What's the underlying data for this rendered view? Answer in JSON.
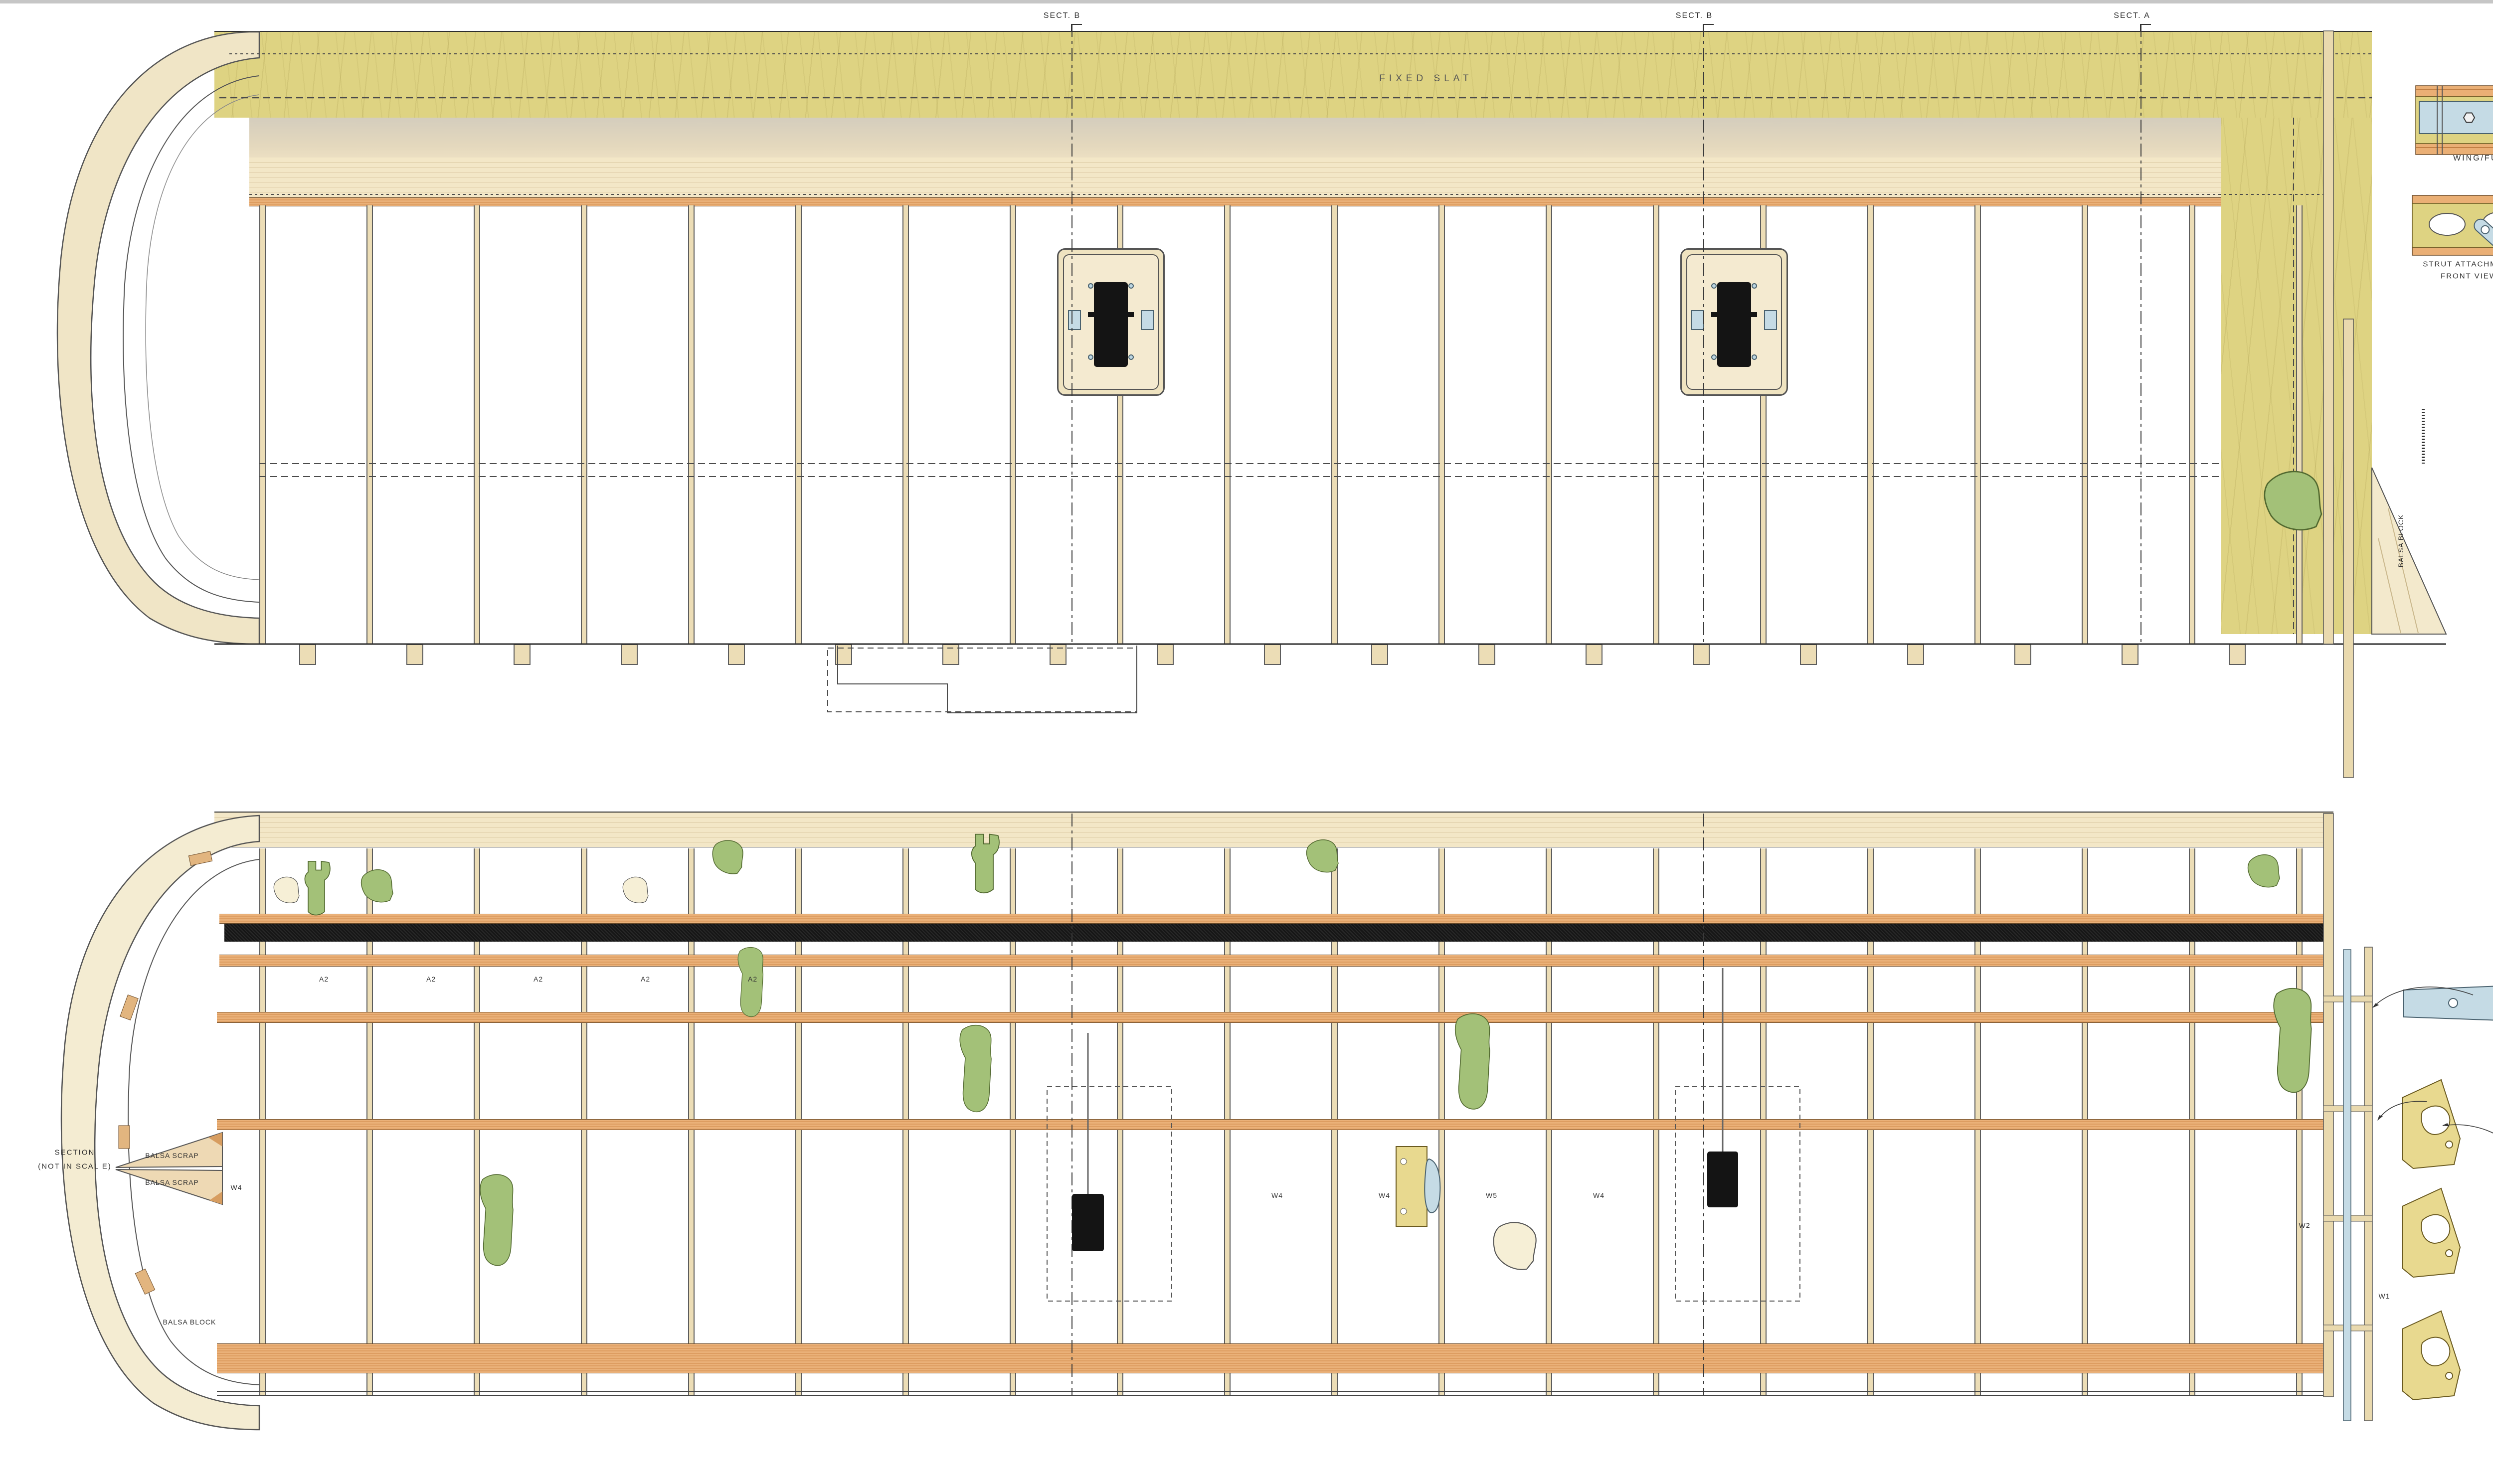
{
  "plan_top": {
    "slat_label": "FIXED SLAT",
    "balsa_block_label": "BALSA BLOCK",
    "section_cuts": [
      {
        "label": "SECT. B"
      },
      {
        "label": "SECT. B"
      },
      {
        "label": "SECT. A"
      }
    ]
  },
  "plan_bottom": {
    "rib_a2_labels": [
      "A2",
      "A2",
      "A2",
      "A2",
      "A2"
    ],
    "rib_w_labels": [
      "W4",
      "W4",
      "W5",
      "W4"
    ],
    "root_labels": {
      "w2": "W2",
      "w1": "W1"
    },
    "tip_label": "W4",
    "section_note_line1": "SECTION",
    "section_note_line2": "(NOT IN SCAL E)",
    "balsa_scrap": "BALSA SCRAP",
    "balsa_block": "BALSA BLOCK"
  },
  "details": {
    "wing_fuselage_label": "WING/FUSELAGE ATTACHMENT",
    "strut_label_line1": "STRUT ATTACHMENT",
    "strut_label_line2": "FRONT VIEW"
  },
  "cross_sections": {
    "sect_a": "SECT. A",
    "sect_b": "SECT. B",
    "sect_c": "SECT. C",
    "epoxy_line1": "EPOXY",
    "epoxy_line2": "GLUE",
    "spar_note": "BALSA/CARBONFIBER SPAR",
    "dont_glue_note": "DON'T GLUE BEFORE COVERING AND PAINTING",
    "flap": "FLAP",
    "aileron": "AILERON",
    "vac_formed": "VAC-U FORMED",
    "poplar_ply": "POPLAR PLY"
  },
  "parts": {
    "w2": "W2",
    "w3": "W3",
    "w4": "W4",
    "w5": "W5",
    "a1": "A1",
    "a2": "A2",
    "a3": "A3"
  },
  "scale_bar": {
    "cm_labels": [
      "0",
      "1",
      "2",
      "3",
      "4",
      "5",
      "6",
      "7",
      "8",
      "9",
      "10 cm"
    ],
    "in_labels": [
      "0",
      "1",
      "2",
      "3",
      "4 in"
    ]
  },
  "legend": {
    "items": [
      {
        "label": "BIRCH PLYWOOD",
        "color": "#e5d289",
        "text_color": "#3a3a3a"
      },
      {
        "label": "BALSA",
        "color": "#f4e4c3",
        "text_color": "#3a3a3a"
      },
      {
        "label": "SPRUCE OR CEDAR",
        "color": "#eaaf75",
        "text_color": "#3a3a3a"
      },
      {
        "label": "LINDEN",
        "color": "#f3e0bd",
        "text_color": "#3a3a3a"
      },
      {
        "label": "POPLAR PLYWOOD",
        "color": "#f8f4dd",
        "text_color": "#3a3a3a"
      },
      {
        "label": "METAL",
        "color": "#c2d9e3",
        "text_color": "#3a3a3a"
      },
      {
        "label": "FIBERGLASS",
        "color": "#a3c178",
        "text_color": "#3a3a3a"
      },
      {
        "label": "CARBON FIBER",
        "color": "#151515",
        "text_color": "#f0f0f0"
      }
    ]
  },
  "title_block": {
    "title": "FIESELER FI 156 STORCH",
    "subtitle": "1/4 SCALE",
    "specs": [
      {
        "label": "Wingspan",
        "value": "354 cm (139,37 in)"
      },
      {
        "label": "Lenght",
        "value": "242 cm (95,27 in)"
      },
      {
        "label": "Wing area",
        "value": "175 sq/dm (18,8 sq/ft)"
      },
      {
        "label": "Weight",
        "value": "11,5 Kg / (25,35 lb)"
      },
      {
        "label": "Engine",
        "value": "Laser 300 90° twin 4 stroke 50 cc"
      }
    ],
    "sheet_info": "SHEET 3 OF 3 - WINGS",
    "project": "PROJECT BY PAOLO SEVERIN 2004",
    "plans": "PLANS DRAWN DECEMBER 2008",
    "website": "www.paoloseverin.it"
  }
}
